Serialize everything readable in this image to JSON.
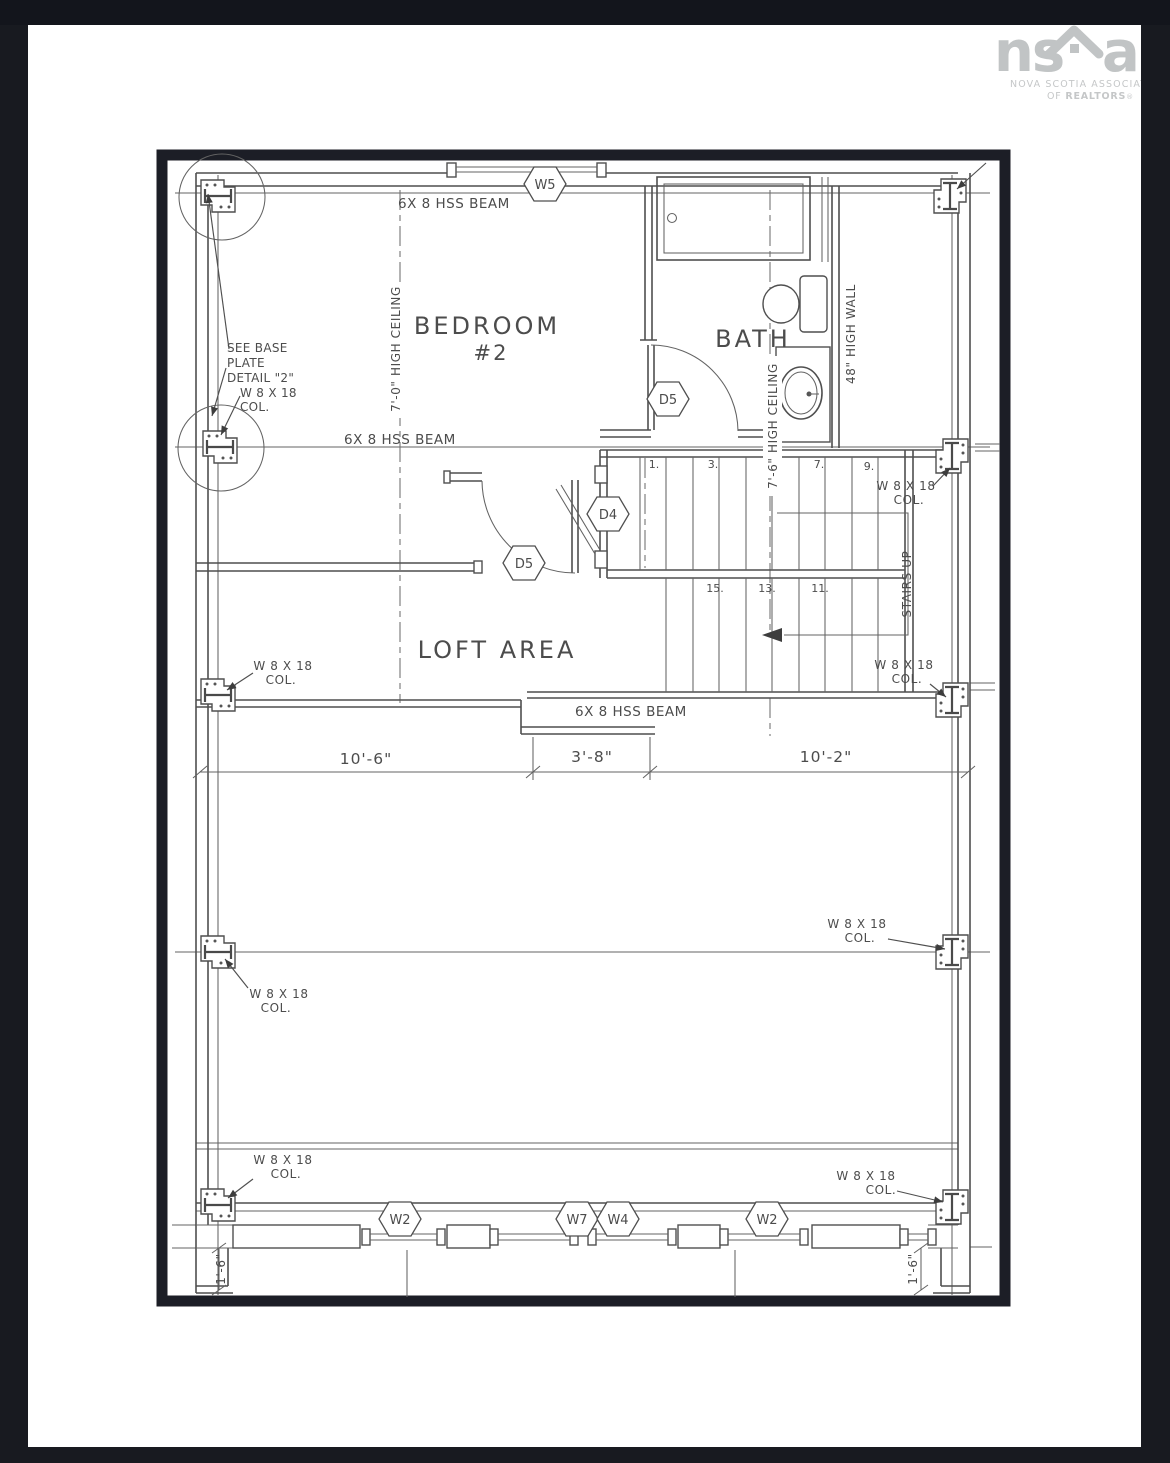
{
  "page": {
    "bg": "#181a20",
    "card_bg": "#ffffff"
  },
  "logo": {
    "part1": "ns",
    "part2": "ar",
    "line1": "NOVA SCOTIA ASSOCIATION",
    "line2_pre": "OF ",
    "line2_bold": "REALTORS",
    "reg": "®",
    "color": "#c1c4c5"
  },
  "plan": {
    "line_color": "#4f4f4f",
    "frame_color": "#1c1e26",
    "labels": {
      "bedroom1": "BEDROOM",
      "bedroom2": "#2",
      "bath": "BATH",
      "loft": "LOFT AREA",
      "beam": "6X 8 HSS BEAM",
      "ceiling70": "7'-0\" HIGH CEILING",
      "ceiling76": "7'-6\" HIGH CEILING",
      "highwall": "48\" HIGH WALL",
      "stairsup": "STAIRS UP",
      "col1": "W 8 X 18",
      "col2": "COL.",
      "note1": "SEE BASE",
      "note2": "PLATE",
      "note3": "DETAIL \"2\"",
      "note4": "W 8 X 18",
      "note5": "COL."
    },
    "dims": {
      "a": "10'-6\"",
      "b": "3'-8\"",
      "c": "10'-2\"",
      "corner": "1'-6\""
    },
    "stairs": {
      "n1": "1.",
      "n3": "3.",
      "n7": "7.",
      "n9": "9.",
      "n15": "15.",
      "n13": "13.",
      "n11": "11."
    },
    "tags": {
      "w5": "W5",
      "d5": "D5",
      "d4": "D4",
      "w2": "W2",
      "w7": "W7",
      "w4": "W4"
    }
  }
}
